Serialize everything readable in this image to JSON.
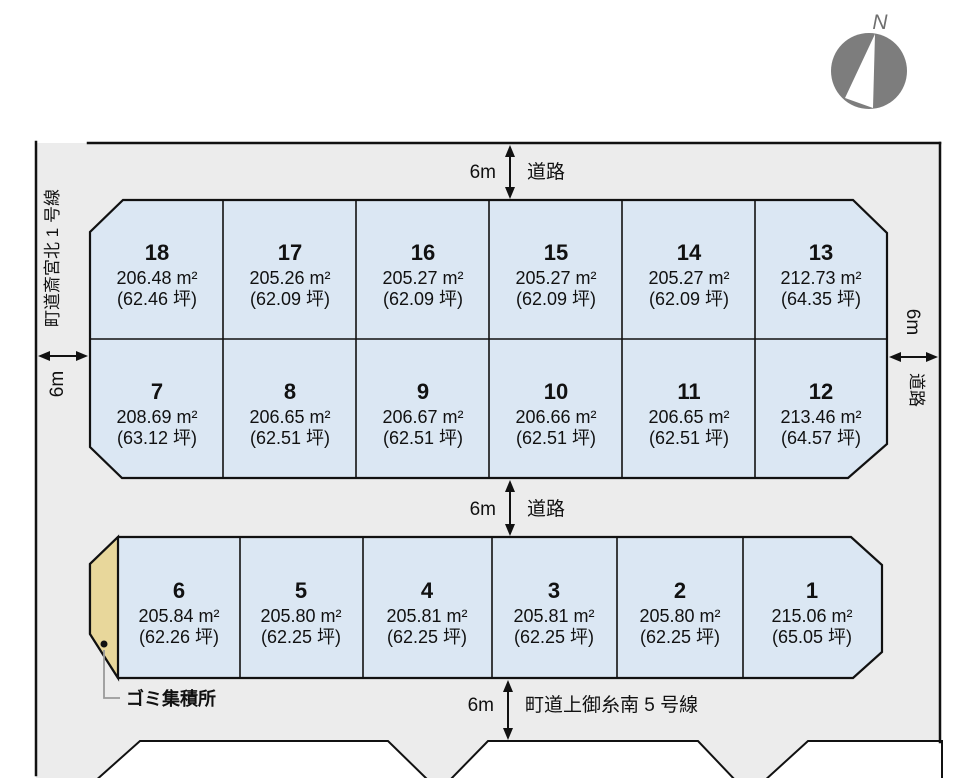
{
  "compass": {
    "label": "N"
  },
  "roads": {
    "top": {
      "width": "6m",
      "name": "道路"
    },
    "middle": {
      "width": "6m",
      "name": "道路"
    },
    "bottom": {
      "width": "6m",
      "name": "町道上御糸南 5 号線"
    },
    "left": {
      "width": "6m",
      "name": "町道斎宮北 1 号線"
    },
    "right": {
      "width": "6m",
      "name": "道路"
    }
  },
  "garbage_station": {
    "label": "ゴミ集積所"
  },
  "lots": {
    "row_top": [
      {
        "number": "18",
        "area_m2": "206.48 m²",
        "area_tsubo": "(62.46 坪)"
      },
      {
        "number": "17",
        "area_m2": "205.26 m²",
        "area_tsubo": "(62.09 坪)"
      },
      {
        "number": "16",
        "area_m2": "205.27 m²",
        "area_tsubo": "(62.09 坪)"
      },
      {
        "number": "15",
        "area_m2": "205.27 m²",
        "area_tsubo": "(62.09 坪)"
      },
      {
        "number": "14",
        "area_m2": "205.27 m²",
        "area_tsubo": "(62.09 坪)"
      },
      {
        "number": "13",
        "area_m2": "212.73 m²",
        "area_tsubo": "(64.35 坪)"
      }
    ],
    "row_middle": [
      {
        "number": "7",
        "area_m2": "208.69 m²",
        "area_tsubo": "(63.12 坪)"
      },
      {
        "number": "8",
        "area_m2": "206.65 m²",
        "area_tsubo": "(62.51 坪)"
      },
      {
        "number": "9",
        "area_m2": "206.67 m²",
        "area_tsubo": "(62.51 坪)"
      },
      {
        "number": "10",
        "area_m2": "206.66 m²",
        "area_tsubo": "(62.51 坪)"
      },
      {
        "number": "11",
        "area_m2": "206.65 m²",
        "area_tsubo": "(62.51 坪)"
      },
      {
        "number": "12",
        "area_m2": "213.46 m²",
        "area_tsubo": "(64.57 坪)"
      }
    ],
    "row_bottom": [
      {
        "number": "6",
        "area_m2": "205.84 m²",
        "area_tsubo": "(62.26 坪)"
      },
      {
        "number": "5",
        "area_m2": "205.80 m²",
        "area_tsubo": "(62.25 坪)"
      },
      {
        "number": "4",
        "area_m2": "205.81 m²",
        "area_tsubo": "(62.25 坪)"
      },
      {
        "number": "3",
        "area_m2": "205.81 m²",
        "area_tsubo": "(62.25 坪)"
      },
      {
        "number": "2",
        "area_m2": "205.80 m²",
        "area_tsubo": "(62.25 坪)"
      },
      {
        "number": "1",
        "area_m2": "215.06 m²",
        "area_tsubo": "(65.05 坪)"
      }
    ]
  },
  "colors": {
    "page_bg": "#ffffff",
    "road_fill": "#ececec",
    "lot_fill": "#dbe7f3",
    "garbage_fill": "#e8d79b",
    "outline": "#111111",
    "compass_gray": "#7d7d7d"
  }
}
